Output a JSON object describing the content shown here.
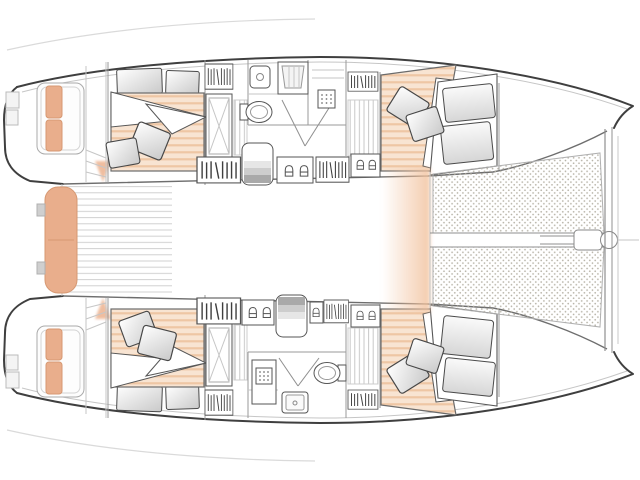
{
  "document": {
    "kind": "floor-plan",
    "subject": "catamaran",
    "view": "top-down-deck-plan",
    "orientation": "bow-right"
  },
  "colors": {
    "background": "#ffffff",
    "hull_outline": "#3f3f3f",
    "line_mid": "#8f8f8f",
    "line_light": "#c6c6c6",
    "cushion_peach": "#e9ae8c",
    "cushion_peach_edge": "#d69872",
    "bed_stripe_light": "#f8e4d2",
    "bed_stripe_dark": "#eec6a4",
    "glow_peach": "#f2c29e",
    "net_dot": "#b6b2a6",
    "plank_line": "#d0d0d0",
    "stair_dark": "#9e9e9e",
    "fixture_stroke": "#555555"
  },
  "inventory": {
    "hulls": 2,
    "cabins": 4,
    "double_beds": 4,
    "bathrooms": 2,
    "toilets": 2,
    "showers": 2,
    "companionway_stairs": 2,
    "trampoline_net_sections": 2,
    "stern_bench": 1,
    "transom_platforms": 2,
    "loose_pillows": 8,
    "headboard_cushions": 4,
    "berth_cushions": 4
  }
}
